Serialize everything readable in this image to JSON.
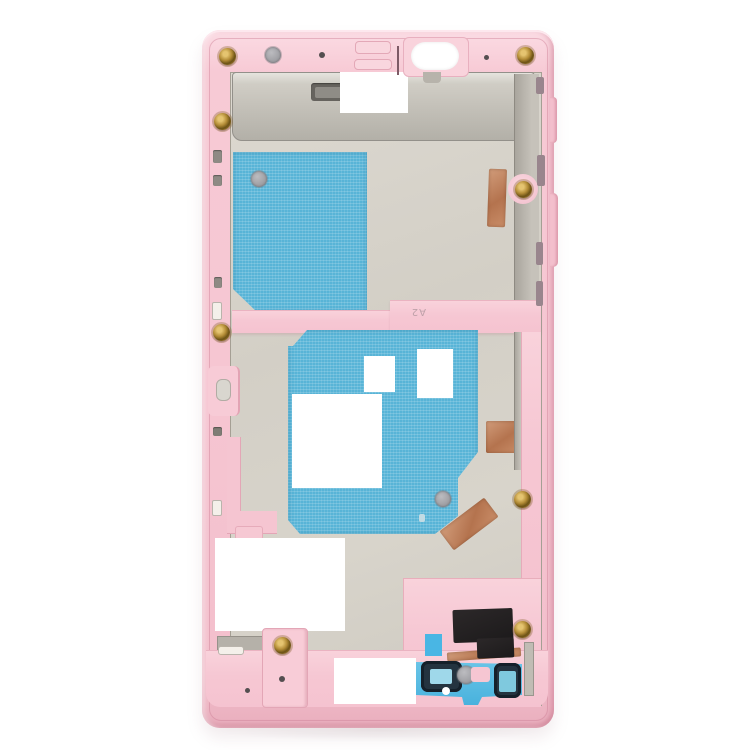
{
  "image": {
    "type": "product-photo",
    "subject": "Smartphone middle frame housing (pink), internal rear view with adhesive sheets and shields",
    "background_color": "#ffffff"
  },
  "markings": {
    "frame_label": "A2"
  },
  "palette": {
    "frame_pink": "#f6c6d2",
    "frame_pink_light": "#fbdce4",
    "frame_pink_shadow": "#e9aebd",
    "metal_plate": "#d5d1c8",
    "metal_shield": "#c2bfb7",
    "adhesive_blue": "#58b4d7",
    "copper_tape": "#b4734e",
    "screw_gold": "#b38c36",
    "speaker_black": "#1c1a1b",
    "flex_cyan": "#49b2dd",
    "gasket_navy": "#24333f",
    "cutout_white": "#ffffff"
  },
  "parts": [
    {
      "name": "middle-frame",
      "color": "#f6c6d2"
    },
    {
      "name": "top-metal-shield",
      "color": "#c2bfb7"
    },
    {
      "name": "front-camera-cutout",
      "color": "#ffffff"
    },
    {
      "name": "camera-hole-sticker",
      "color": "#8e8e93"
    },
    {
      "name": "upper-adhesive-sheet",
      "color": "#58b4d7"
    },
    {
      "name": "lower-adhesive-sheet",
      "color": "#58b4d7"
    },
    {
      "name": "copper-tape-strip",
      "color": "#b4734e"
    },
    {
      "name": "copper-tape-square",
      "color": "#b4734e"
    },
    {
      "name": "copper-tape-diagonal",
      "color": "#b4734e"
    },
    {
      "name": "gold-screws",
      "count": 8,
      "color": "#b38c36"
    },
    {
      "name": "loudspeaker-contact-block",
      "color": "#1c1a1b"
    },
    {
      "name": "bottom-flex-cable",
      "color": "#49b2dd"
    },
    {
      "name": "side-button-ribs",
      "color": "#f2bcca"
    }
  ]
}
